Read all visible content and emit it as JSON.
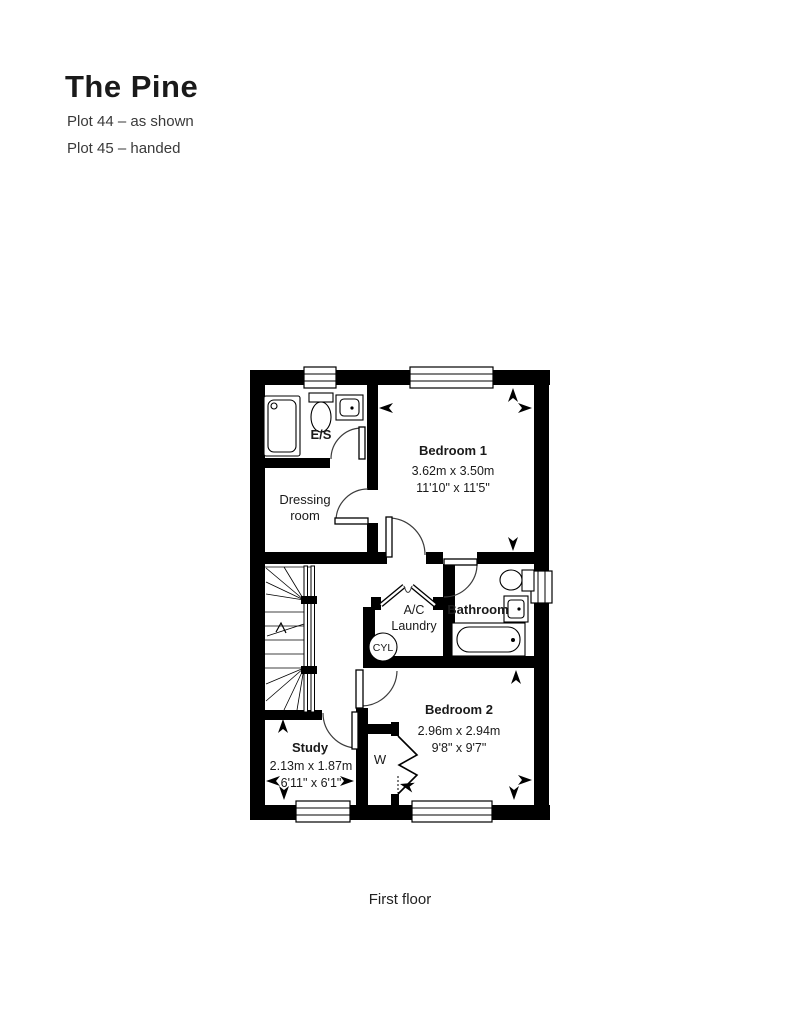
{
  "colors": {
    "accent": "#F5A623",
    "heading_text": "#3A3A3A",
    "plan_ink": "#000000"
  },
  "header": {
    "title": "The Pine",
    "plot_lines": [
      {
        "label": "Plot 44 – as shown"
      },
      {
        "label": "Plot 45 – handed"
      }
    ]
  },
  "rooms": {
    "ensuite": {
      "name": "E/S"
    },
    "dressing": {
      "name_line1": "Dressing",
      "name_line2": "room"
    },
    "bedroom1": {
      "name": "Bedroom 1",
      "metric": "3.62m x 3.50m",
      "imperial": "11'10\" x 11'5\""
    },
    "bathroom": {
      "name": "Bathroom"
    },
    "laundry": {
      "name_line1": "A/C",
      "name_line2": "Laundry",
      "cylinder_label": "CYL"
    },
    "bedroom2": {
      "name": "Bedroom 2",
      "metric": "2.96m x 2.94m",
      "imperial": "9'8\" x 9'7\""
    },
    "study": {
      "name": "Study",
      "metric": "2.13m x 1.87m",
      "imperial": "6'11\" x 6'1\""
    },
    "wardrobe": {
      "name": "W"
    }
  },
  "caption": {
    "label": "First floor"
  }
}
